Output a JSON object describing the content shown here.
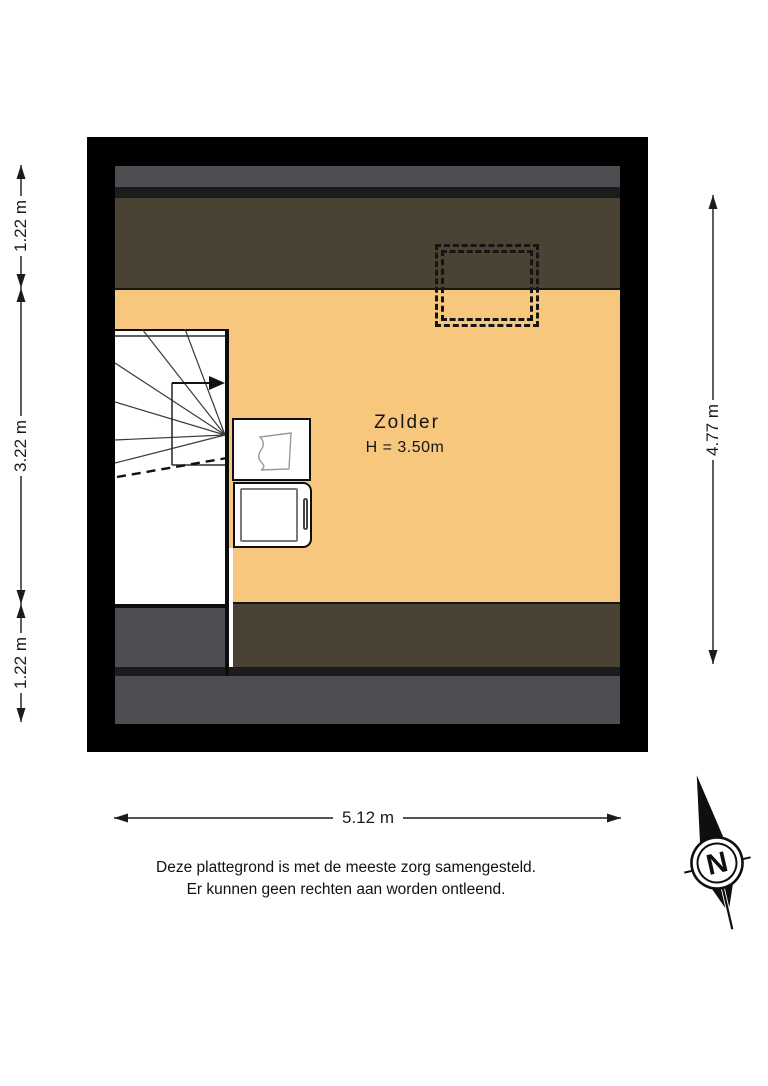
{
  "plan": {
    "room": {
      "name": "Zolder",
      "height": "H = 3.50m"
    }
  },
  "dimensions": {
    "left": [
      "1.22 m",
      "3.22 m",
      "1.22 m"
    ],
    "right": "4.77 m",
    "bottom": "5.12 m"
  },
  "disclaimer": {
    "line1": "Deze plattegrond is met de meeste zorg samengesteld.",
    "line2": "Er kunnen geen rechten aan worden ontleend."
  },
  "compass": {
    "label": "N"
  },
  "colors": {
    "wall": "#000000",
    "floor": "#f6c77d",
    "roof-slope": "#4a4233",
    "roof-strip-gray": "#4e4e52",
    "roof-strip-dark": "#1c1c1c",
    "line": "#1a1a1a",
    "fixture-bg": "#ffffff"
  }
}
